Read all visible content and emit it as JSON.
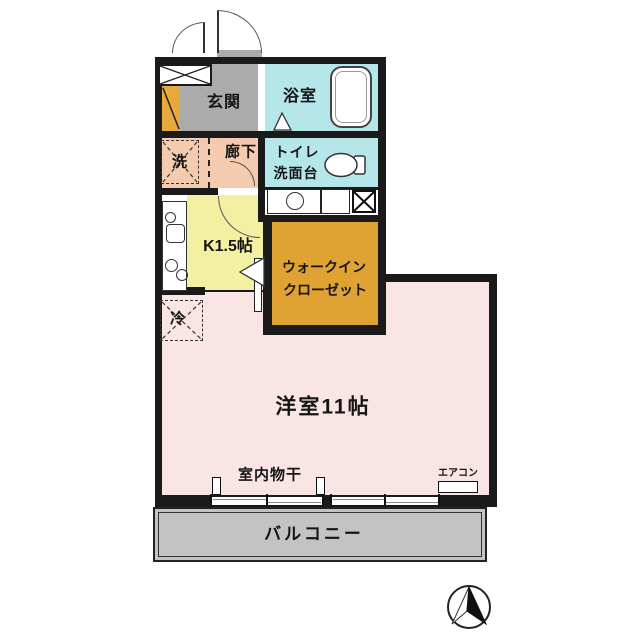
{
  "floorplan": {
    "rooms": {
      "entrance": "玄関",
      "bathroom": "浴室",
      "washer": "洗",
      "hallway": "廊下",
      "toilet_line1": "トイレ",
      "toilet_line2": "洗面台",
      "kitchen": "K1.5帖",
      "closet_line1": "ウォークイン",
      "closet_line2": "クローゼット",
      "fridge": "冷",
      "main_room": "洋室11帖",
      "indoor_drying": "室内物干",
      "aircon": "エアコン",
      "balcony": "バルコニー"
    },
    "colors": {
      "wall": "#1a1a1a",
      "entrance-gray": "#ababab",
      "water-cyan": "#b4e6ea",
      "hallway-salmon": "#f4cbae",
      "kitchen-yellow": "#f4f0a2",
      "closet-orange": "#dfa233",
      "room-pink": "#f9e5e4",
      "balcony-gray": "#c3c3c3",
      "shoe-orange": "#e8a93c"
    }
  }
}
